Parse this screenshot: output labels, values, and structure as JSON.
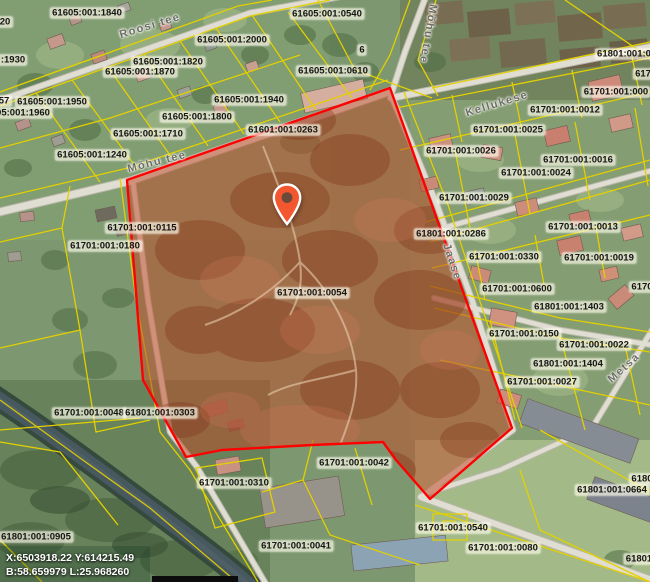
{
  "map": {
    "selected_parcel_code": "61701:001:0054",
    "status_bar": {
      "coords_xy": "X:6503918.22 Y:614215.49",
      "coords_bl": "B:58.659979 L:25.968260"
    },
    "colors": {
      "parcel_line": "#e3d000",
      "selected_parcel_fill": "#c04a28",
      "selected_parcel_stroke": "#ff0000",
      "pin": "#f2572f",
      "label_text": "#151515",
      "street_text": "#6c6c64"
    },
    "pin": {
      "x": 287,
      "y": 227
    },
    "street_labels": [
      {
        "text": "Roosi tee",
        "x": 150,
        "y": 26,
        "rot": -17
      },
      {
        "text": "Mõhu tee",
        "x": 428,
        "y": 34,
        "rot": 100
      },
      {
        "text": "Mõhu tee",
        "x": 157,
        "y": 162,
        "rot": -14
      },
      {
        "text": "Kellukese",
        "x": 497,
        "y": 104,
        "rot": -17
      },
      {
        "text": "Jaase",
        "x": 452,
        "y": 262,
        "rot": 72
      },
      {
        "text": "Metsa",
        "x": 624,
        "y": 368,
        "rot": -42
      }
    ],
    "parcel_labels": [
      {
        "text": "61605:001:1840",
        "x": 87,
        "y": 13
      },
      {
        "text": "20",
        "x": 5,
        "y": 22
      },
      {
        "text": "61605:001:2000",
        "x": 232,
        "y": 40
      },
      {
        "text": "61605:001:0540",
        "x": 327,
        "y": 14
      },
      {
        "text": ":1930",
        "x": 13,
        "y": 60
      },
      {
        "text": "61605:001:1820",
        "x": 168,
        "y": 62
      },
      {
        "text": "61605:001:1870",
        "x": 140,
        "y": 72
      },
      {
        "text": "61605:001:0610",
        "x": 333,
        "y": 71
      },
      {
        "text": "6",
        "x": 362,
        "y": 50
      },
      {
        "text": "57",
        "x": 4,
        "y": 101
      },
      {
        "text": "61605:001:1950",
        "x": 52,
        "y": 102
      },
      {
        "text": "05:001:1960",
        "x": 23,
        "y": 113
      },
      {
        "text": "61605:001:1940",
        "x": 249,
        "y": 100
      },
      {
        "text": "61605:001:1800",
        "x": 197,
        "y": 117
      },
      {
        "text": "61601:001:0263",
        "x": 283,
        "y": 130
      },
      {
        "text": "61605:001:1710",
        "x": 148,
        "y": 134
      },
      {
        "text": "61605:001:1240",
        "x": 92,
        "y": 155
      },
      {
        "text": "61801:001:0",
        "x": 624,
        "y": 54
      },
      {
        "text": "617",
        "x": 643,
        "y": 74
      },
      {
        "text": "61701:001:000",
        "x": 616,
        "y": 92
      },
      {
        "text": "61701:001:0012",
        "x": 565,
        "y": 110
      },
      {
        "text": "61701:001:0025",
        "x": 508,
        "y": 130
      },
      {
        "text": "61701:001:0026",
        "x": 461,
        "y": 151
      },
      {
        "text": "61701:001:0016",
        "x": 578,
        "y": 160
      },
      {
        "text": "61701:001:0024",
        "x": 536,
        "y": 173
      },
      {
        "text": "61701:001:0029",
        "x": 474,
        "y": 198
      },
      {
        "text": "61701:001:0013",
        "x": 583,
        "y": 227
      },
      {
        "text": "61801:001:0286",
        "x": 451,
        "y": 234
      },
      {
        "text": "61701:001:0115",
        "x": 142,
        "y": 228
      },
      {
        "text": "61701:001:0180",
        "x": 105,
        "y": 246
      },
      {
        "text": "61701:001:0330",
        "x": 504,
        "y": 257
      },
      {
        "text": "61701:001:0019",
        "x": 599,
        "y": 258
      },
      {
        "text": "6170",
        "x": 642,
        "y": 287
      },
      {
        "text": "61701:001:0600",
        "x": 517,
        "y": 289
      },
      {
        "text": "61701:001:0054",
        "x": 312,
        "y": 293
      },
      {
        "text": "61801:001:1403",
        "x": 569,
        "y": 307
      },
      {
        "text": "61701:001:0150",
        "x": 524,
        "y": 334
      },
      {
        "text": "61701:001:0022",
        "x": 594,
        "y": 345
      },
      {
        "text": "61801:001:1404",
        "x": 568,
        "y": 364
      },
      {
        "text": "61701:001:0027",
        "x": 542,
        "y": 382
      },
      {
        "text": "61701:001:0048",
        "x": 89,
        "y": 413
      },
      {
        "text": "61801:001:0303",
        "x": 160,
        "y": 413
      },
      {
        "text": "61701:001:0042",
        "x": 354,
        "y": 463
      },
      {
        "text": "6180",
        "x": 642,
        "y": 479
      },
      {
        "text": "61701:001:0310",
        "x": 234,
        "y": 483
      },
      {
        "text": "61801:001:0664",
        "x": 612,
        "y": 490
      },
      {
        "text": "61701:001:0540",
        "x": 453,
        "y": 528
      },
      {
        "text": "61801:001:0905",
        "x": 36,
        "y": 537
      },
      {
        "text": "61701:001:0041",
        "x": 296,
        "y": 546
      },
      {
        "text": "61701:001:0080",
        "x": 503,
        "y": 548
      },
      {
        "text": "61801",
        "x": 639,
        "y": 559
      }
    ]
  }
}
